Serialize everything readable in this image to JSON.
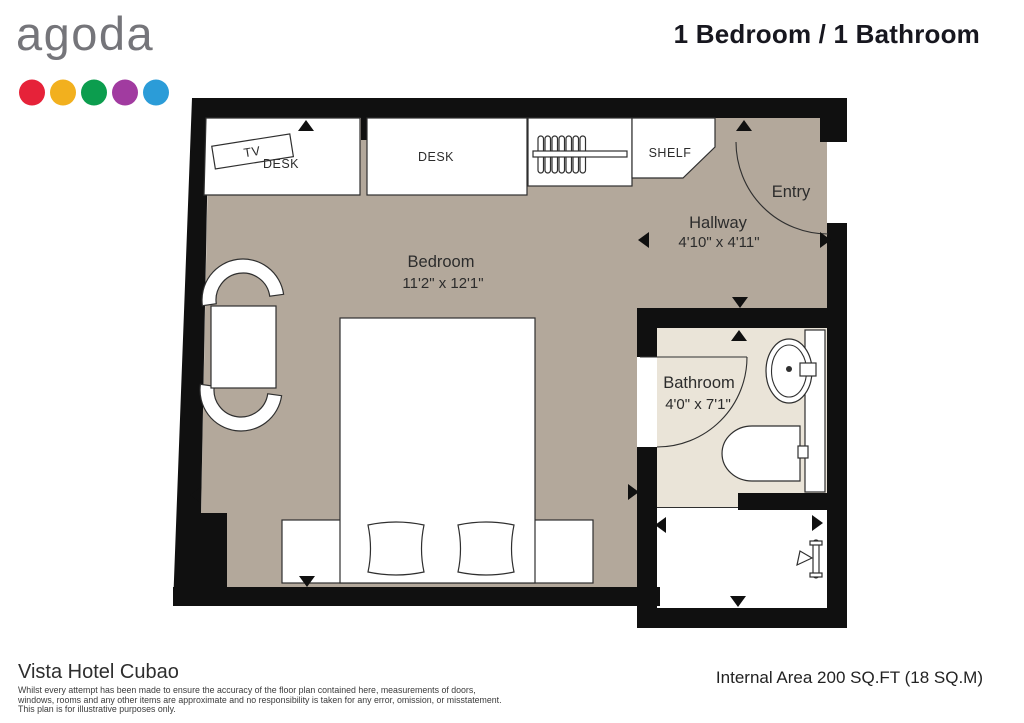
{
  "header": {
    "logo_text": "agoda",
    "title": "1 Bedroom / 1 Bathroom"
  },
  "plan": {
    "labels": {
      "bedroom": {
        "name": "Bedroom",
        "dims": "11'2\" x 12'1\""
      },
      "hallway": {
        "name": "Hallway",
        "dims": "4'10\" x 4'11\""
      },
      "bathroom": {
        "name": "Bathroom",
        "dims": "4'0\" x 7'1\""
      },
      "entry": {
        "name": "Entry"
      },
      "tv": "TV",
      "desk_left": "DESK",
      "desk_center": "DESK",
      "shelf": "SHELF"
    },
    "colors": {
      "wall": "#101010",
      "bedroom_floor": "#b3a89b",
      "bathroom_floor": "#eae4d8",
      "furniture_fill": "#ffffff",
      "outline": "#2f2f2f",
      "dot_red": "#e62239",
      "dot_orange": "#f2b01e",
      "dot_green": "#0c9d4e",
      "dot_purple": "#a13ba0",
      "dot_blue": "#2b9cd8"
    }
  },
  "footer": {
    "hotel_name": "Vista Hotel Cubao",
    "disclaimer_line1": "Whilst every attempt has been made to ensure the accuracy of the floor plan contained here, measurements of doors,",
    "disclaimer_line2": "windows, rooms and any other items are approximate and no responsibility is taken for any error, omission, or misstatement.",
    "disclaimer_line3": "This plan is for illustrative purposes only.",
    "area_text": "Internal Area 200 SQ.FT (18 SQ.M)"
  }
}
